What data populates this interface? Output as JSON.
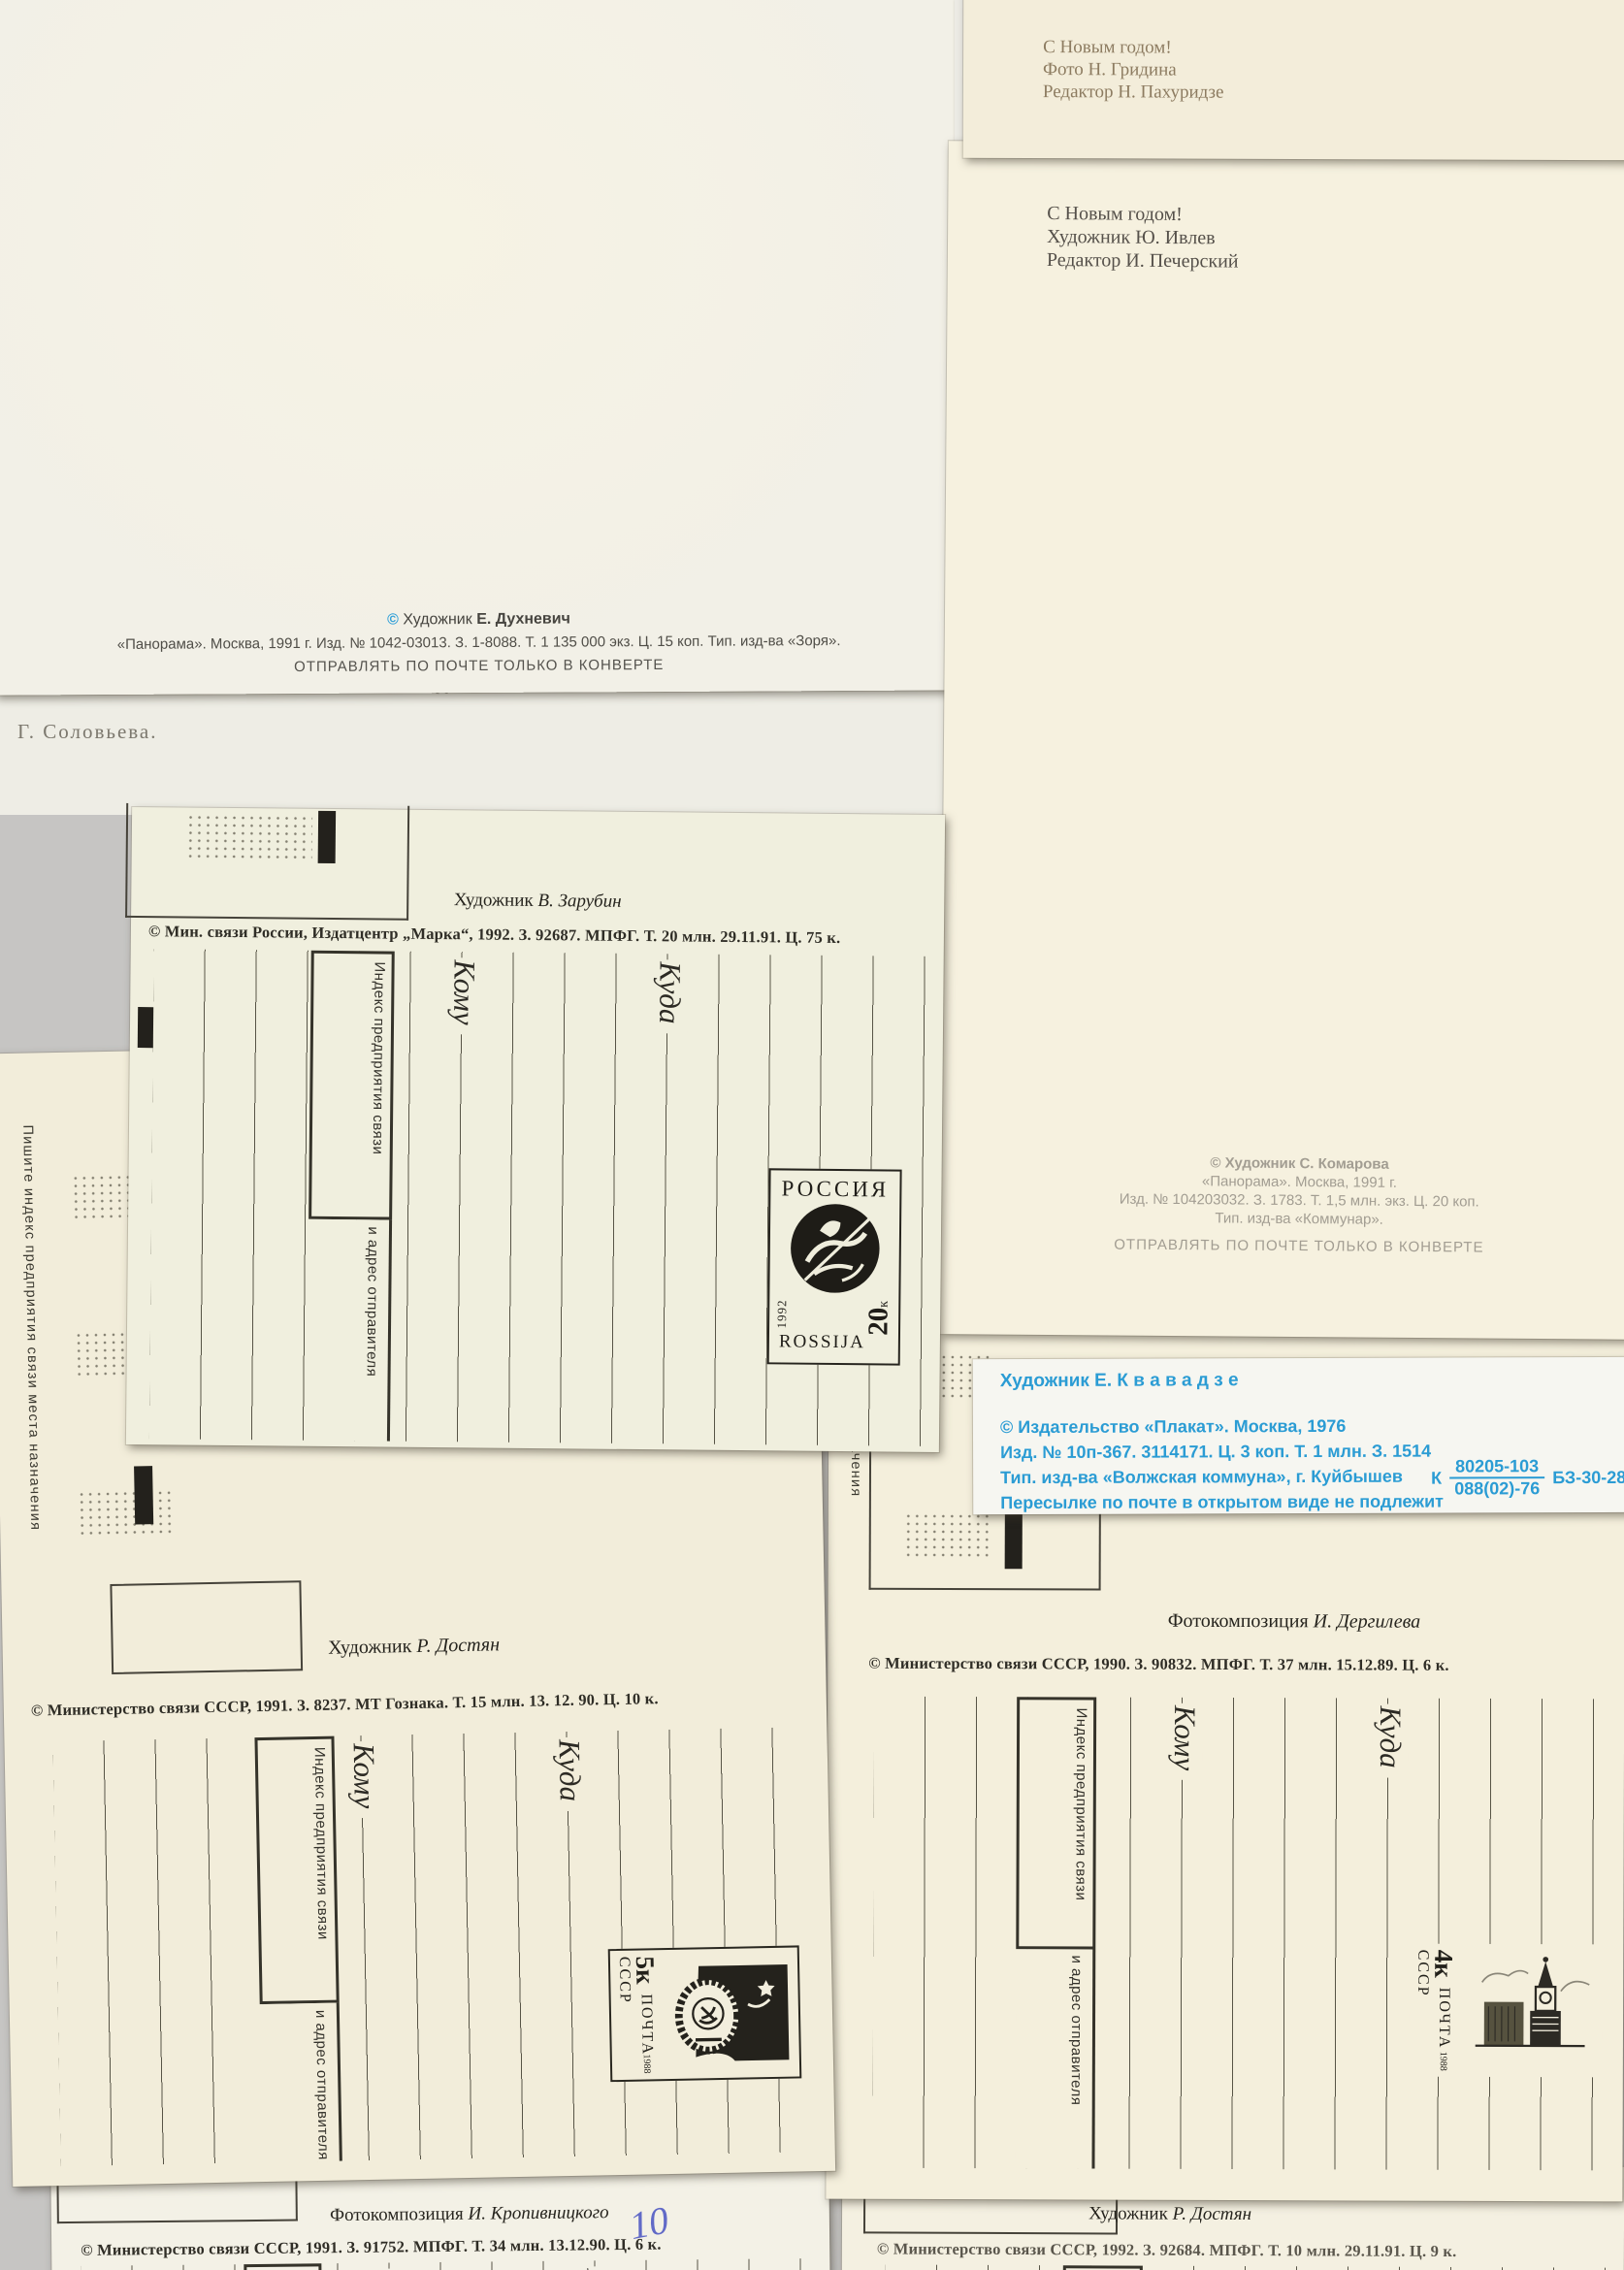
{
  "labels": {
    "komu": "Кому",
    "kuda": "Куда",
    "index_line1": "Индекс предприятия связи",
    "index_line2": "и адрес отправителя",
    "edge_note": "Пишите индекс предприятия связи места назначения"
  },
  "cards": {
    "dukhnevich": {
      "copyright": "©",
      "artist_label": "Художник",
      "artist_name": "Е. Духневич",
      "imprint": "«Панорама». Москва, 1991 г. Изд. № 1042-03013. З. 1-8088. Т. 1 135 000 экз. Ц. 15 коп. Тип. изд-ва «Зоря».",
      "notice": "ОТПРАВЛЯТЬ ПО ПОЧТЕ ТОЛЬКО В КОНВЕРТЕ"
    },
    "solovyova": {
      "caption": "Г. Соловьева.",
      "mark": "С"
    },
    "gridina": {
      "lines": [
        "С Новым годом!",
        "Фото Н. Гридина",
        "Редактор Н. Пахуридзе"
      ]
    },
    "ivlev": {
      "lines": [
        "С Новым годом!",
        "Художник Ю. Ивлев",
        "Редактор И. Печерский"
      ],
      "komarova": [
        "© Художник С. Комарова",
        "«Панорама». Москва, 1991 г.",
        "Изд. № 104203032. З. 1783. Т. 1,5 млн. экз. Ц. 20 коп.",
        "Тип. изд-ва «Коммунар»."
      ],
      "notice": "ОТПРАВЛЯТЬ ПО ПОЧТЕ ТОЛЬКО В КОНВЕРТЕ"
    },
    "zarubin": {
      "header_label": "Художник",
      "header_name": "В. Зарубин",
      "imprint": "© Мин. связи России, Издатцентр „Марка“, 1992. З. 92687. МПФГ. Т. 20 млн. 29.11.91. Ц. 75 к."
    },
    "kvavadze": {
      "artist": "Художник  Е. К в а в а д з е",
      "line1": "© Издательство «Плакат». Москва, 1976",
      "line2": "Изд. № 10п-367. 3114171. Ц. 3 коп. Т. 1 млн. З. 1514",
      "line3": "Тип. изд-ва «Волжская коммуна», г. Куйбышев",
      "line4": "Пересылке по почте в открытом виде не подлежит",
      "code_prefix": "К",
      "code_top": "80205-103",
      "code_bottom": "088(02)-76",
      "code_right": "БЗ-30-28-76",
      "accent": "#2b9cd4"
    },
    "dostyan": {
      "header_label": "Художник",
      "header_name": "Р. Достян",
      "imprint": "© Министерство связи СССР, 1991. З. 8237. МТ Гознака. Т. 15 млн. 13. 12. 90. Ц. 10 к."
    },
    "dergileva": {
      "header_label": "Фотокомпозиция",
      "header_name": "И. Дергилева",
      "imprint": "© Министерство связи СССР, 1990. З. 90832. МПФГ. Т. 37 млн. 15.12.89. Ц. 6 к."
    },
    "kropivnitsky": {
      "header_label": "Фотокомпозиция",
      "header_name": "И. Кропивницкого",
      "imprint": "© Министерство связи СССР, 1991. З. 91752. МПФГ. Т. 34 млн. 13.12.90. Ц. 6 к.",
      "handwriting": "10"
    },
    "dostyan2": {
      "header_label": "Художник",
      "header_name": "Р. Достян",
      "imprint": "© Министерство связи СССР, 1992. З. 92684. МПФГ. Т. 10 млн. 29.11.91. Ц. 9 к."
    }
  },
  "stamps": {
    "russia20": {
      "country": "РОССИЯ",
      "country_latin": "ROSSIJA",
      "year": "1992",
      "value": "20",
      "unit": "к"
    },
    "ussr5": {
      "value": "5к",
      "post": "ПОЧТА СССР",
      "year": "1988"
    },
    "ussr4": {
      "value": "4к",
      "post": "ПОЧТА СССР",
      "year": "1988"
    }
  }
}
